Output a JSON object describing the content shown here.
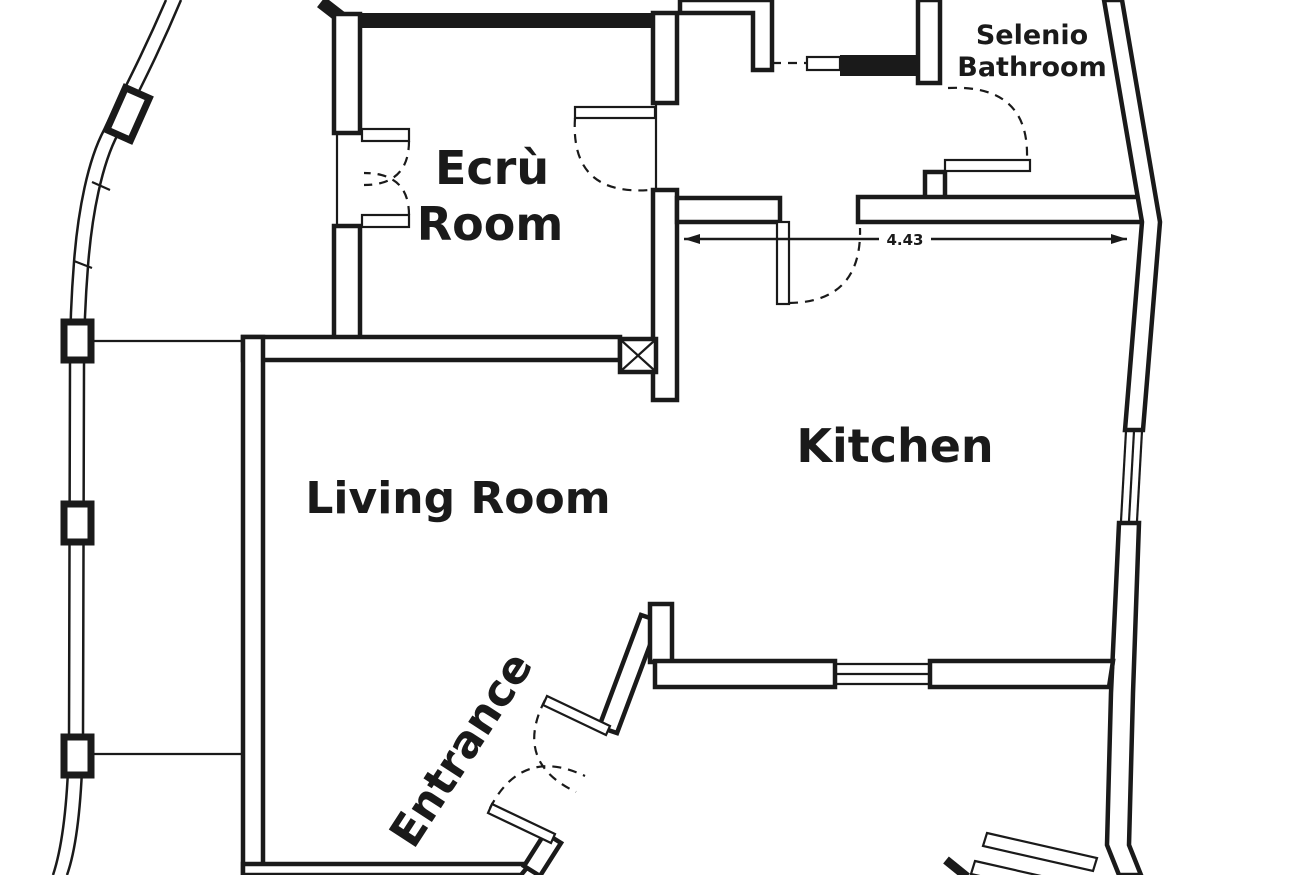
{
  "colors": {
    "ink": "#1a1a1a",
    "background": "#ffffff"
  },
  "rooms": {
    "ecru": {
      "line1": "Ecrù",
      "line2": "Room"
    },
    "bathroom": {
      "line1": "Selenio",
      "line2": "Bathroom"
    },
    "kitchen": {
      "label": "Kitchen"
    },
    "living": {
      "label": "Living Room"
    },
    "entrance": {
      "label": "Entrance"
    }
  },
  "dimension": {
    "value": "4.43"
  }
}
